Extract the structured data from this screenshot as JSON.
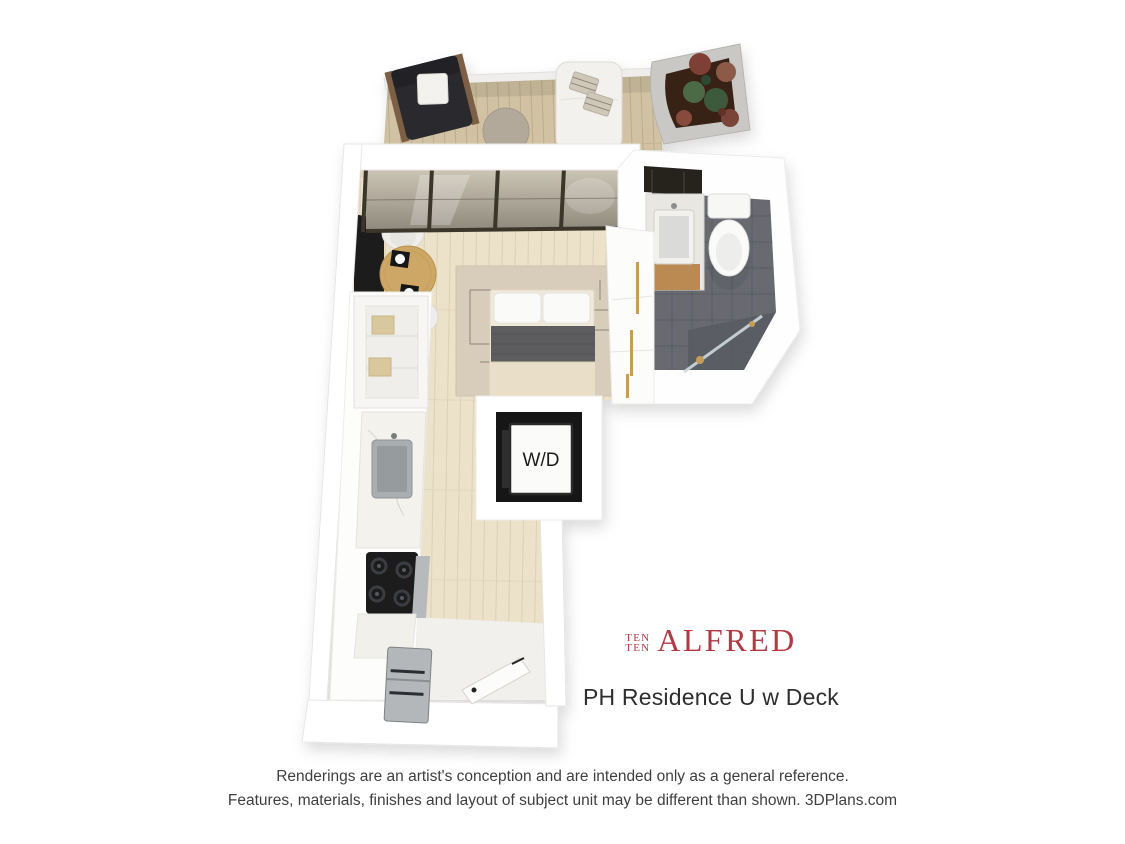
{
  "branding": {
    "prefix_line1": "TEN",
    "prefix_line2": "TEN",
    "name": "ALFRED",
    "logo_color": "#b23944"
  },
  "unit": {
    "title": "PH Residence U w Deck",
    "washer_dryer_label": "W/D"
  },
  "disclaimer": {
    "line1": "Renderings are an artist's conception and are intended only as a general reference.",
    "line2": "Features, materials, finishes and layout of subject unit may be different than shown. 3DPlans.com"
  },
  "colors": {
    "logo_red": "#b23944",
    "title_text": "#2e2e2e",
    "disclaimer_text": "#3e3e3e",
    "deck_wood": "#d0c2a2",
    "interior_wood": "#ece1c9",
    "bathroom_tile": "#676a70",
    "wall_white": "#ffffff",
    "window_frame": "#3b352c",
    "gold_hardware": "#c69d57"
  }
}
